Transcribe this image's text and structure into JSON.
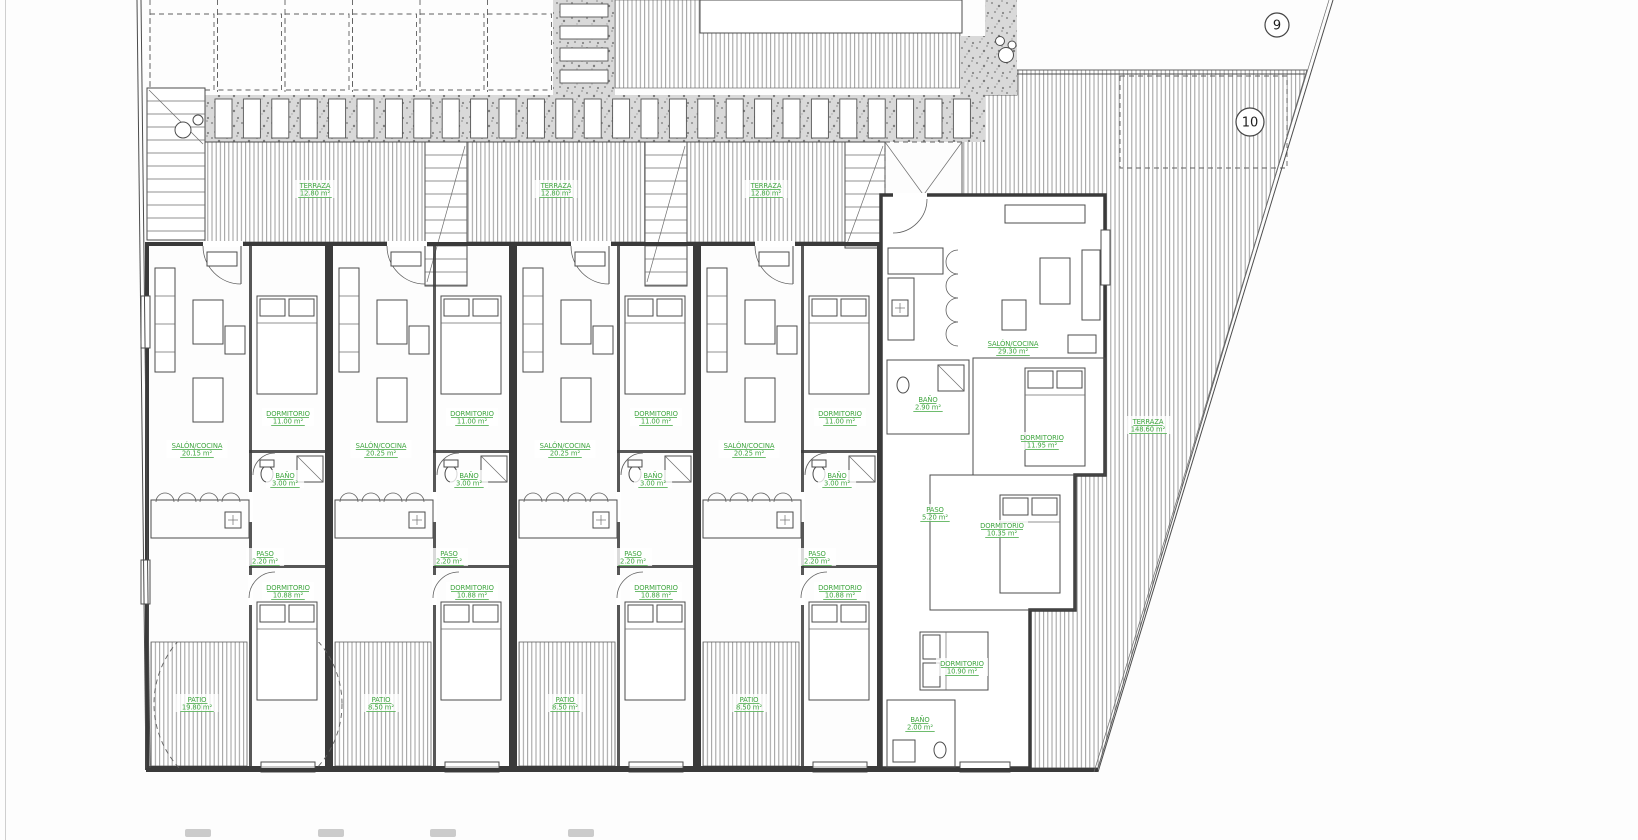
{
  "app": {
    "type": "architectural-floor-plan",
    "background": "#ffffff"
  },
  "colors": {
    "wall": "#3a3a3a",
    "thin_line": "#4c4c4c",
    "hatch": "#9d9d9d",
    "gravel": "#d6d6d6",
    "label_green": "#3fa53f",
    "marker_stroke": "#444444"
  },
  "plan": {
    "markers": [
      {
        "label": "9",
        "x": 1277,
        "y": 25,
        "r": 12
      },
      {
        "label": "10",
        "x": 1250,
        "y": 122,
        "r": 14
      }
    ],
    "room_labels": [
      {
        "name": "TERRAZA",
        "area": "12.80 m²",
        "x": 315,
        "y": 188
      },
      {
        "name": "TERRAZA",
        "area": "12.80 m²",
        "x": 556,
        "y": 188
      },
      {
        "name": "TERRAZA",
        "area": "12.80 m²",
        "x": 766,
        "y": 188
      },
      {
        "name": "TERRAZA",
        "area": "148.60 m²",
        "x": 1148,
        "y": 424
      },
      {
        "name": "SALÓN/COCINA",
        "area": "20.15 m²",
        "x": 197,
        "y": 448
      },
      {
        "name": "SALÓN/COCINA",
        "area": "20.25 m²",
        "x": 381,
        "y": 448
      },
      {
        "name": "SALÓN/COCINA",
        "area": "20.25 m²",
        "x": 565,
        "y": 448
      },
      {
        "name": "SALÓN/COCINA",
        "area": "20.25 m²",
        "x": 749,
        "y": 448
      },
      {
        "name": "DORMITORIO",
        "area": "11.00 m²",
        "x": 288,
        "y": 416
      },
      {
        "name": "DORMITORIO",
        "area": "11.00 m²",
        "x": 472,
        "y": 416
      },
      {
        "name": "DORMITORIO",
        "area": "11.00 m²",
        "x": 656,
        "y": 416
      },
      {
        "name": "DORMITORIO",
        "area": "11.00 m²",
        "x": 840,
        "y": 416
      },
      {
        "name": "BAÑO",
        "area": "3.00 m²",
        "x": 285,
        "y": 478
      },
      {
        "name": "BAÑO",
        "area": "3.00 m²",
        "x": 469,
        "y": 478
      },
      {
        "name": "BAÑO",
        "area": "3.00 m²",
        "x": 653,
        "y": 478
      },
      {
        "name": "BAÑO",
        "area": "3.00 m²",
        "x": 837,
        "y": 478
      },
      {
        "name": "PASO",
        "area": "2.20 m²",
        "x": 265,
        "y": 556
      },
      {
        "name": "PASO",
        "area": "2.20 m²",
        "x": 449,
        "y": 556
      },
      {
        "name": "PASO",
        "area": "2.20 m²",
        "x": 633,
        "y": 556
      },
      {
        "name": "PASO",
        "area": "2.20 m²",
        "x": 817,
        "y": 556
      },
      {
        "name": "DORMITORIO",
        "area": "10.88 m²",
        "x": 288,
        "y": 590
      },
      {
        "name": "DORMITORIO",
        "area": "10.88 m²",
        "x": 472,
        "y": 590
      },
      {
        "name": "DORMITORIO",
        "area": "10.88 m²",
        "x": 656,
        "y": 590
      },
      {
        "name": "DORMITORIO",
        "area": "10.88 m²",
        "x": 840,
        "y": 590
      },
      {
        "name": "PATIO",
        "area": "19.80 m²",
        "x": 197,
        "y": 702
      },
      {
        "name": "PATIO",
        "area": "8.50 m²",
        "x": 381,
        "y": 702
      },
      {
        "name": "PATIO",
        "area": "8.50 m²",
        "x": 565,
        "y": 702
      },
      {
        "name": "PATIO",
        "area": "8.50 m²",
        "x": 749,
        "y": 702
      },
      {
        "name": "SALÓN/COCINA",
        "area": "29.30 m²",
        "x": 1013,
        "y": 346
      },
      {
        "name": "BAÑO",
        "area": "2.90 m²",
        "x": 928,
        "y": 402
      },
      {
        "name": "DORMITORIO",
        "area": "11.95 m²",
        "x": 1042,
        "y": 440
      },
      {
        "name": "PASO",
        "area": "5.20 m²",
        "x": 935,
        "y": 512
      },
      {
        "name": "DORMITORIO",
        "area": "10.35 m²",
        "x": 1002,
        "y": 528
      },
      {
        "name": "DORMITORIO",
        "area": "10.90 m²",
        "x": 962,
        "y": 666
      },
      {
        "name": "BAÑO",
        "area": "2.00 m²",
        "x": 920,
        "y": 722
      }
    ],
    "smudges": [
      {
        "x": 185
      },
      {
        "x": 318
      },
      {
        "x": 430
      },
      {
        "x": 568
      }
    ]
  }
}
